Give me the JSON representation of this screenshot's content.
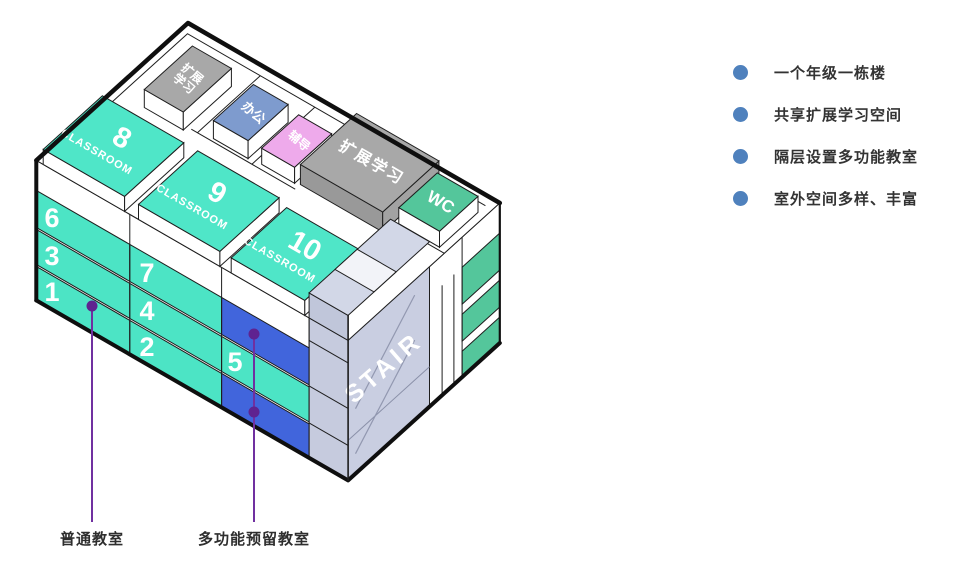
{
  "building": {
    "floors": {
      "f1": "1",
      "f2": "2",
      "f3": "3",
      "f4": "4",
      "f5": "5",
      "f6": "6",
      "f7": "7"
    },
    "penthouse": {
      "r8": "8",
      "r9": "9",
      "r10": "10"
    },
    "classroom_word": "CLASSROOM",
    "rooms": {
      "ext_small_1": "扩展",
      "ext_small_2": "学习",
      "office": "办公",
      "counseling": "辅导",
      "ext_large": "扩展学习",
      "wc": "WC",
      "stair": "STAIR"
    }
  },
  "annotations": {
    "ordinary": "普通教室",
    "multifunction": "多功能预留教室"
  },
  "legend": {
    "items": [
      "一个年级一栋楼",
      "共享扩展学习空间",
      "隔层设置多功能教室",
      "室外空间多样、丰富"
    ]
  },
  "colors": {
    "teal": "#4ce4c5",
    "green": "#54c69b",
    "multifunction_blue": "#4165dc",
    "office_blue": "#7e9bce",
    "counseling_pink": "#eeaaeb",
    "gray": "#a8a8a8",
    "stair_lavender": "#c9cee1",
    "bullet_blue": "#4f81bd",
    "leader_purple": "#7030a0"
  }
}
